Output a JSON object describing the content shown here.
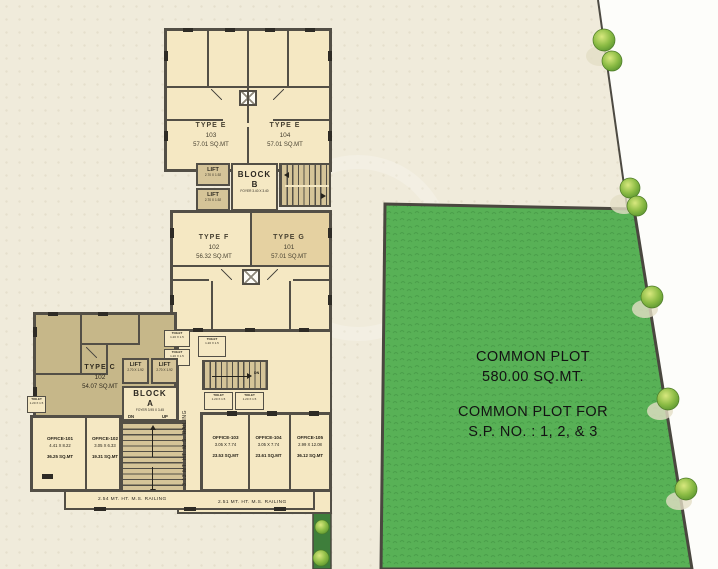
{
  "units": {
    "e103": {
      "type": "TYPE E",
      "no": "103",
      "area": "57.01 SQ.MT"
    },
    "e104": {
      "type": "TYPE E",
      "no": "104",
      "area": "57.01 SQ.MT"
    },
    "f102": {
      "type": "TYPE F",
      "no": "102",
      "area": "56.32 SQ.MT"
    },
    "g101": {
      "type": "TYPE G",
      "no": "101",
      "area": "57.01 SQ.MT"
    },
    "c102": {
      "type": "TYPE C",
      "no": "102",
      "area": "54.07 SQ.MT"
    }
  },
  "offices": [
    {
      "name": "OFFICE-101",
      "dims": "4.41 X 8.22",
      "area": "36.25 SQ.MT"
    },
    {
      "name": "OFFICE-102",
      "dims": "3.05 X 6.33",
      "area": "19.31 SQ.MT"
    },
    {
      "name": "OFFICE-103",
      "dims": "3.05 X 7.74",
      "area": "23.53 SQ.MT"
    },
    {
      "name": "OFFICE-104",
      "dims": "3.05 X 7.74",
      "area": "23.61 SQ.MT"
    },
    {
      "name": "OFFICE-105",
      "dims": "2.99 X 12.08",
      "area": "36.12 SQ.MT"
    }
  ],
  "lift": {
    "label": "LIFT",
    "dims": "2.70 X 1.92"
  },
  "block_a": {
    "word": "BLOCK",
    "letter": "A",
    "foyer": "FOYER 3.95 X 3.45"
  },
  "block_b": {
    "word": "BLOCK",
    "letter": "B",
    "foyer": "FOYER 3.40 X 3.40"
  },
  "toilet": {
    "label": "TOILET",
    "dims": "1.20 X 1.5"
  },
  "stairs": {
    "dn": "DN",
    "up": "UP"
  },
  "railings": {
    "side": "3.13 MT. HT. M.S. RAILING",
    "bottom_left": "2.54 MT. HT. M.S. RAILING",
    "bottom_right": "2.51 MT. HT. M.S. RAILING"
  },
  "common_plot": {
    "name": "COMMON PLOT",
    "area": "580.00 SQ.MT.",
    "for_line1": "COMMON PLOT FOR",
    "for_line2": "S.P. NO. : 1, 2, & 3"
  },
  "colors": {
    "background": "#f0ebdb",
    "wall": "#534f46",
    "room_cream": "#f5e8c3",
    "room_tan": "#e5d1a1",
    "room_olive": "#c6b789",
    "plot_green": "#58b156",
    "hedge_green": "#3e7e3b",
    "outside_white": "#fdfdfa"
  }
}
